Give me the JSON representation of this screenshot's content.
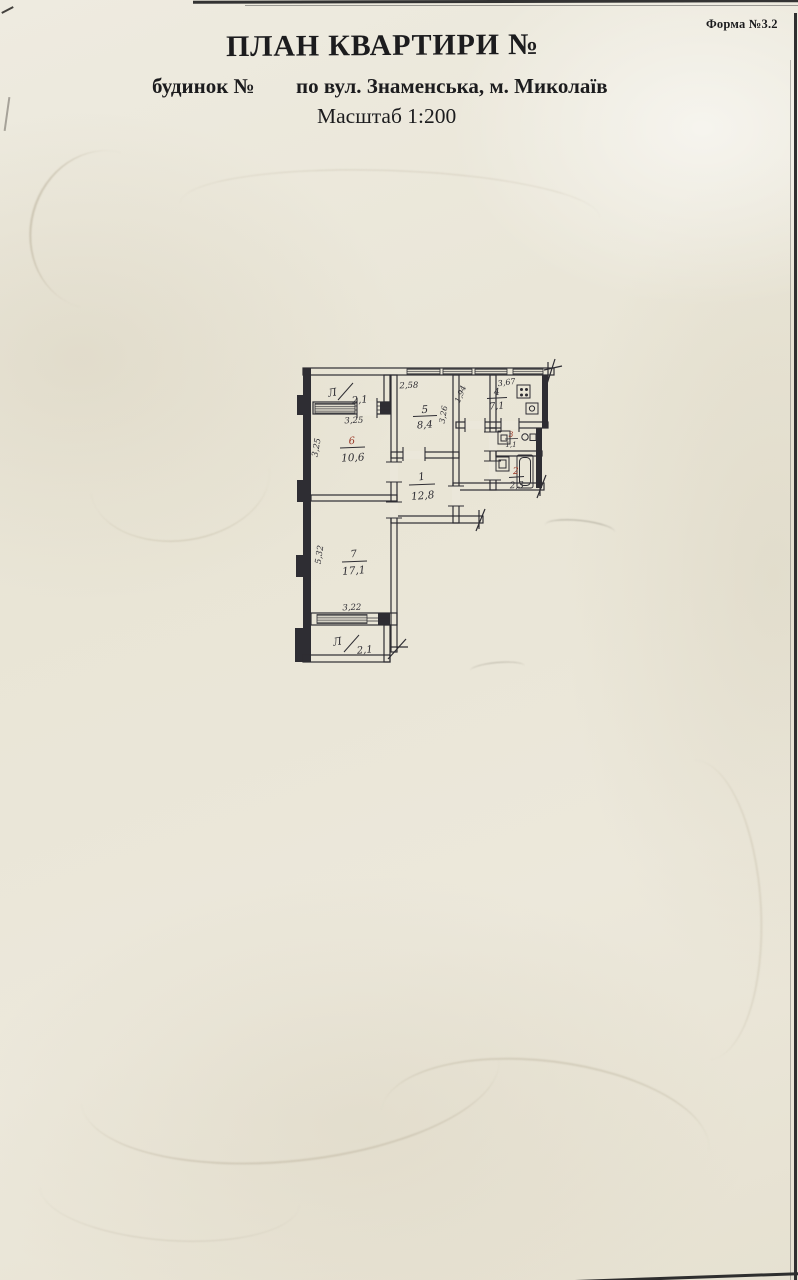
{
  "page": {
    "form_label": "Форма №3.2",
    "title": "ПЛАН КВАРТИРИ №",
    "building_label": "будинок №",
    "address": "по вул. Знаменська, м. Миколаїв",
    "scale_label": "Масштаб 1:200"
  },
  "plan": {
    "scale": "1:200",
    "rooms": {
      "r1": {
        "number": "1",
        "area": "12,8",
        "ink": "black"
      },
      "r2": {
        "number": "2",
        "area": "2,3",
        "ink": "red"
      },
      "r3": {
        "number": "3",
        "area": "1,1",
        "ink": "red"
      },
      "r4": {
        "number": "4",
        "area": "7,1",
        "ink": "black"
      },
      "r5": {
        "number": "5",
        "area": "8,4",
        "ink": "black"
      },
      "r6": {
        "number": "6",
        "area": "10,6",
        "ink": "red"
      },
      "r7": {
        "number": "7",
        "area": "17,1",
        "ink": "black"
      }
    },
    "loggias": {
      "top": {
        "label": "Л",
        "area": "2,1"
      },
      "bottom": {
        "label": "Л",
        "area": "2,1"
      }
    },
    "dimensions": {
      "room5_top": "2,58",
      "kitchen_top": "3,67",
      "hall_width": "1,94",
      "room5_right": "3,26",
      "loggia_top_width": "3,25",
      "room6_left": "3,25",
      "room7_left": "5,32",
      "room7_bottom": "3,22"
    },
    "fixtures": [
      "stove-icon",
      "kitchen-sink-icon",
      "washbasin-icon",
      "faucet-icon",
      "bathtub-icon"
    ],
    "colors": {
      "ink": "#2e2d33",
      "red_ink": "#9a3726",
      "paper": "#ebe7da"
    }
  }
}
